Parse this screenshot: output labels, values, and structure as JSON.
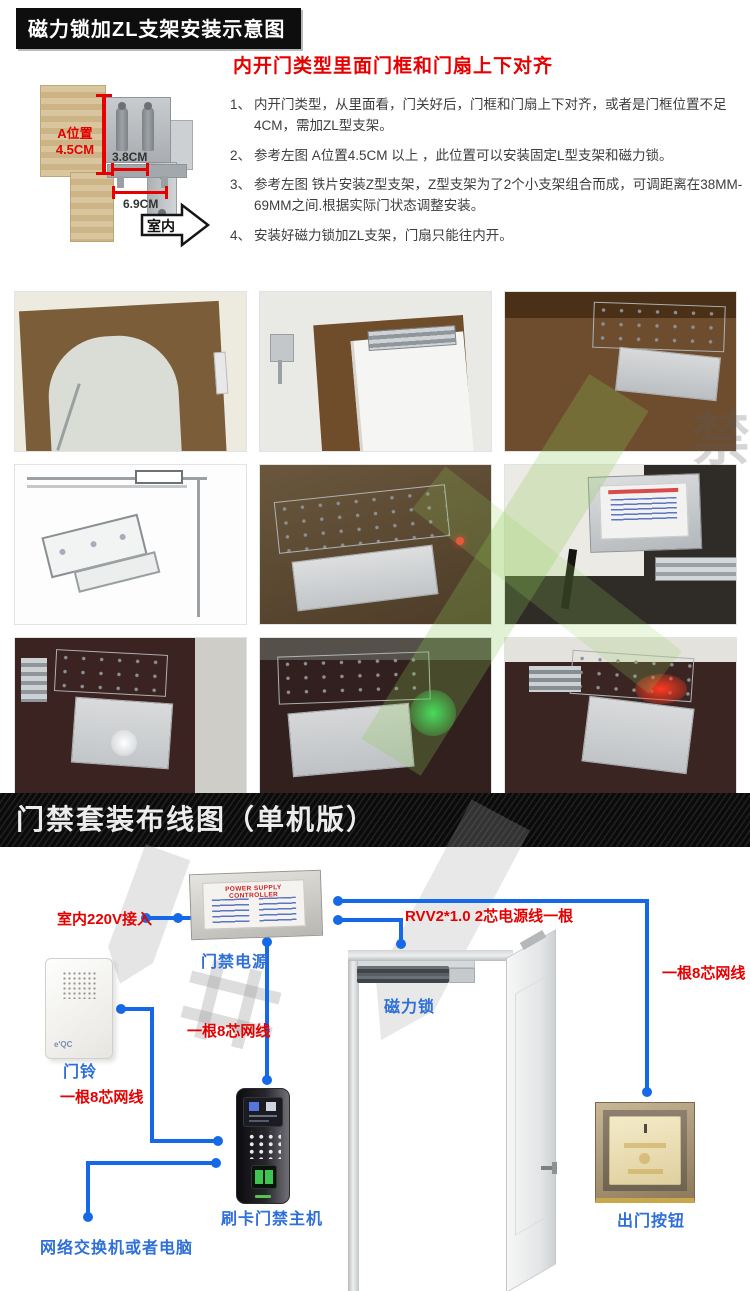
{
  "title_bar": {
    "text": "磁力锁加ZL支架安装示意图"
  },
  "intro": {
    "heading": "内开门类型里面门框和门扇上下对齐",
    "items": [
      {
        "n": "1、",
        "t": "内开门类型，从里面看，门关好后，门框和门扇上下对齐，或者是门框位置不足4CM，需加ZL型支架。"
      },
      {
        "n": "2、",
        "t": "参考左图 A位置4.5CM 以上 ，此位置可以安装固定L型支架和磁力锁。"
      },
      {
        "n": "3、",
        "t": "参考左图 铁片安装Z型支架，Z型支架为了2个小支架组合而成，可调距离在38MM-69MM之间.根据实际门状态调整安装。"
      },
      {
        "n": "4、",
        "t": "安装好磁力锁加ZL支架，门扇只能往内开。"
      }
    ]
  },
  "diagram": {
    "a_label_1": "A位置",
    "a_label_2": "4.5CM",
    "dim_38": "3.8CM",
    "dim_69": "6.9CM",
    "indoor": "室内"
  },
  "banner": {
    "text": "门禁套装布线图（单机版）"
  },
  "wiring": {
    "psu_title": "POWER SUPPLY CONTROLLER",
    "mains_label": "室内220V接入",
    "psu_label": "门禁电源",
    "doorbell_label": "门铃",
    "doorbell_brand": "e'QC",
    "net_cable_left": "一根8芯网线",
    "net_cable_mid": "一根8芯网线",
    "net_cable_right": "一根8芯网线",
    "power_cable": "RVV2*1.0 2芯电源线一根",
    "maglock_label": "磁力锁",
    "reader_label": "刷卡门禁主机",
    "switch_label": "网络交换机或者电脑",
    "exit_label": "出门按钮"
  },
  "colors": {
    "wire_blue": "#1569e6",
    "label_blue": "#2e6fd8",
    "label_red": "#e60000",
    "accent_black": "#0e0e0e"
  }
}
